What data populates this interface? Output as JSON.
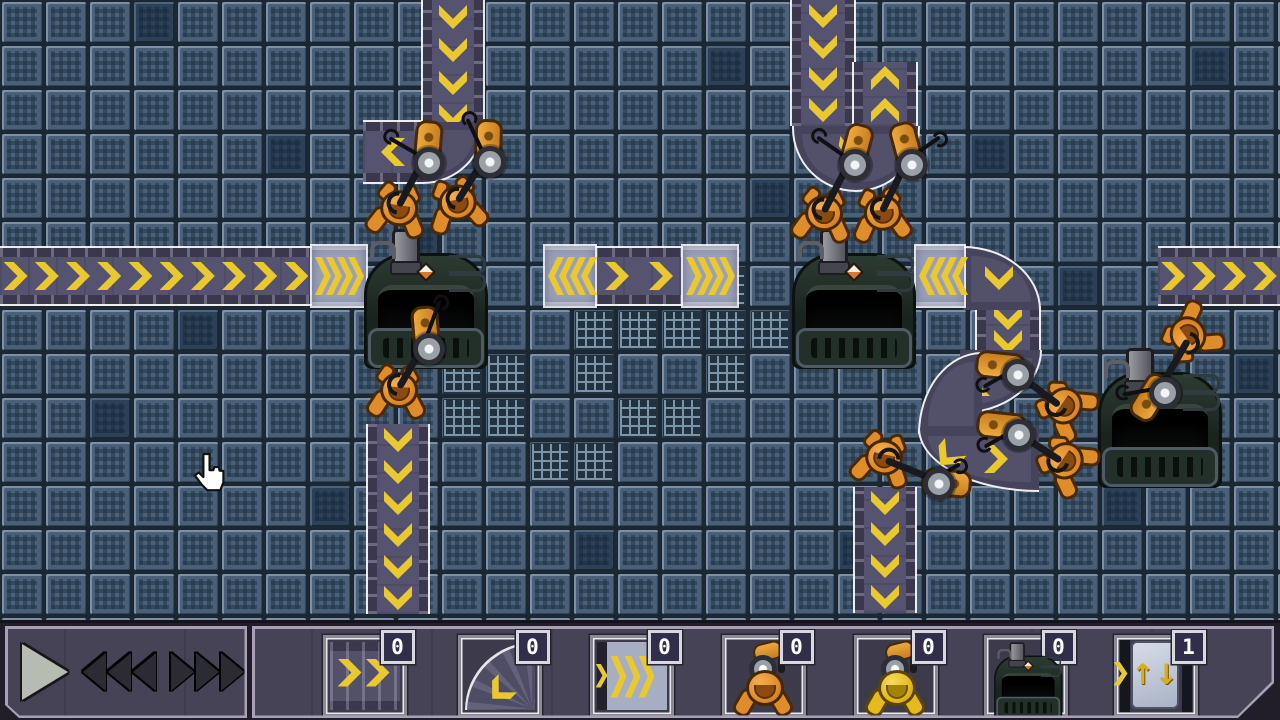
{
  "toolbar": {
    "controls": {
      "play": "play-button",
      "slower": "slow-down-button",
      "faster": "speed-up-button"
    },
    "slots": [
      {
        "item": "straight-conveyor",
        "count": "0"
      },
      {
        "item": "curved-conveyor",
        "count": "0"
      },
      {
        "item": "fast-conveyor",
        "count": "0"
      },
      {
        "item": "grabber-arm-orange",
        "count": "0"
      },
      {
        "item": "grabber-arm-yellow",
        "count": "0"
      },
      {
        "item": "furnace-machine",
        "count": "0"
      },
      {
        "item": "exit-hatch",
        "count": "1"
      }
    ]
  },
  "colors": {
    "chevron": "#e9c92f",
    "belt": "#565370",
    "fast_belt": "#9aa0b8",
    "floor_tile": "#4a6078",
    "machine_body": "#1e2a24",
    "robot_orange": "#df8d2a",
    "robot_yellow": "#e5ba20",
    "panel": "#474356",
    "panel_border": "#a9a0b8",
    "badge_bg": "#312e4a",
    "outline_white": "#ffffff"
  },
  "field": {
    "belts": [
      {
        "x": 423,
        "y": 0,
        "w": 60,
        "h": 132,
        "dir": "down"
      },
      {
        "x": 363,
        "y": 122,
        "w": 60,
        "h": 60,
        "dir": "left",
        "chev": 1
      },
      {
        "x": 0,
        "y": 248,
        "w": 312,
        "h": 56,
        "dir": "right"
      },
      {
        "x": 595,
        "y": 248,
        "w": 88,
        "h": 56,
        "dir": "right"
      },
      {
        "x": 792,
        "y": 0,
        "w": 62,
        "h": 126,
        "dir": "down"
      },
      {
        "x": 854,
        "y": 62,
        "w": 62,
        "h": 64,
        "dir": "up"
      },
      {
        "x": 977,
        "y": 306,
        "w": 62,
        "h": 48,
        "dir": "down",
        "chev": 2
      },
      {
        "x": 368,
        "y": 424,
        "w": 60,
        "h": 190,
        "dir": "down"
      },
      {
        "x": 855,
        "y": 487,
        "w": 60,
        "h": 126,
        "dir": "down"
      },
      {
        "x": 1158,
        "y": 248,
        "w": 122,
        "h": 56,
        "dir": "right"
      }
    ],
    "curves": [
      {
        "x": 423,
        "y": 122,
        "w": 60,
        "h": 60,
        "corner": "br",
        "chevs": []
      },
      {
        "x": 963,
        "y": 246,
        "w": 76,
        "h": 62,
        "corner": "tr",
        "chevs": [
          [
            24,
            16,
            90
          ]
        ]
      },
      {
        "x": 960,
        "y": 350,
        "w": 80,
        "h": 62,
        "corner": "br",
        "chevs": [
          [
            6,
            18,
            180
          ]
        ]
      },
      {
        "x": 918,
        "y": 352,
        "w": 62,
        "h": 80,
        "corner": "tl",
        "chevs": []
      },
      {
        "x": 918,
        "y": 428,
        "w": 119,
        "h": 62,
        "corner": "bl",
        "chevs": [
          [
            16,
            14,
            130
          ],
          [
            64,
            17,
            0
          ]
        ]
      }
    ],
    "ucurves": [
      {
        "x": 792,
        "y": 126,
        "w": 124,
        "h": 64,
        "chevs": [
          [
            46,
            10,
            100
          ]
        ]
      }
    ],
    "fast_belts": [
      {
        "x": 312,
        "y": 246,
        "w": 54,
        "h": 60,
        "dir": "right"
      },
      {
        "x": 545,
        "y": 246,
        "w": 50,
        "h": 60,
        "dir": "left"
      },
      {
        "x": 683,
        "y": 246,
        "w": 54,
        "h": 60,
        "dir": "right"
      },
      {
        "x": 916,
        "y": 246,
        "w": 48,
        "h": 60,
        "dir": "left"
      }
    ],
    "machines": [
      {
        "x": 362,
        "y": 243
      },
      {
        "x": 790,
        "y": 243
      },
      {
        "x": 1096,
        "y": 362
      }
    ],
    "arms": [
      {
        "px": 424,
        "py": 158,
        "base": -85,
        "rod": 118,
        "len": 54,
        "wire": -150,
        "wlen": 40
      },
      {
        "px": 485,
        "py": 157,
        "base": -88,
        "rod": 122,
        "len": 52,
        "wire": -115,
        "wlen": 42
      },
      {
        "px": 850,
        "py": 160,
        "base": -75,
        "rod": 117,
        "len": 58,
        "wire": -145,
        "wlen": 40
      },
      {
        "px": 907,
        "py": 160,
        "base": -105,
        "rod": 116,
        "len": 57,
        "wire": -35,
        "wlen": 40
      },
      {
        "px": 424,
        "py": 344,
        "base": -95,
        "rod": 120,
        "len": 50,
        "wire": -70,
        "wlen": 46
      },
      {
        "px": 1013,
        "py": 370,
        "base": 186,
        "rod": 37,
        "len": 58,
        "wire": 150,
        "wlen": 34
      },
      {
        "px": 1014,
        "py": 430,
        "base": 186,
        "rod": 33,
        "len": 56,
        "wire": 150,
        "wlen": 34
      },
      {
        "px": 934,
        "py": 479,
        "base": 5,
        "rod": 202,
        "len": 52,
        "wire": -30,
        "wlen": 30
      },
      {
        "px": 1160,
        "py": 388,
        "base": 122,
        "rod": -60,
        "len": 56,
        "wire": 170,
        "wlen": 38
      }
    ],
    "robots": [
      {
        "x": 397,
        "y": 209,
        "rot": 8
      },
      {
        "x": 456,
        "y": 204,
        "rot": -12
      },
      {
        "x": 822,
        "y": 214,
        "rot": 6
      },
      {
        "x": 881,
        "y": 214,
        "rot": -6
      },
      {
        "x": 397,
        "y": 391,
        "rot": 3
      },
      {
        "x": 1064,
        "y": 408,
        "rot": -55
      },
      {
        "x": 1065,
        "y": 463,
        "rot": -55
      },
      {
        "x": 882,
        "y": 458,
        "rot": 12
      },
      {
        "x": 1190,
        "y": 336,
        "rot": -125
      }
    ],
    "mesh_tiles": [
      [
        10,
        8
      ],
      [
        11,
        8
      ],
      [
        10,
        9
      ],
      [
        11,
        9
      ],
      [
        13,
        7
      ],
      [
        14,
        7
      ],
      [
        13,
        8
      ],
      [
        15,
        7
      ],
      [
        16,
        6
      ],
      [
        16,
        7
      ],
      [
        17,
        7
      ],
      [
        16,
        8
      ],
      [
        14,
        9
      ],
      [
        15,
        9
      ],
      [
        12,
        10
      ],
      [
        13,
        10
      ]
    ],
    "dark_tiles": [
      [
        3,
        0
      ],
      [
        16,
        1
      ],
      [
        27,
        1
      ],
      [
        10,
        2
      ],
      [
        22,
        3
      ],
      [
        6,
        3
      ],
      [
        0,
        6
      ],
      [
        24,
        6
      ],
      [
        4,
        7
      ],
      [
        17,
        4
      ],
      [
        2,
        9
      ],
      [
        28,
        8
      ],
      [
        7,
        11
      ],
      [
        25,
        11
      ],
      [
        13,
        12
      ],
      [
        19,
        12
      ],
      [
        9,
        5
      ],
      [
        21,
        9
      ]
    ]
  },
  "cursor": {
    "x": 188,
    "y": 452
  }
}
